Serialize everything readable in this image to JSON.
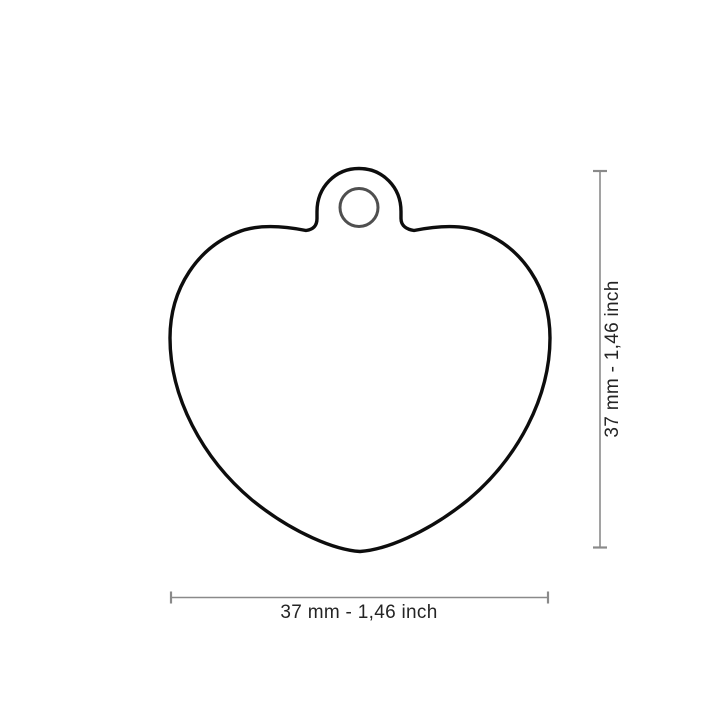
{
  "drawing": {
    "subject": "heart-shaped pet id tag with hanging hole",
    "view": "front outline dimensional drawing"
  },
  "dimensions": {
    "width_label": "37 mm - 1,46 inch",
    "height_label": "37 mm - 1,46 inch"
  },
  "colors": {
    "background": "#ffffff",
    "outline": "#0d0d0d",
    "hole_ring": "#4f4f4f",
    "dimension": "#8a8a8a",
    "label_text": "#242424"
  }
}
